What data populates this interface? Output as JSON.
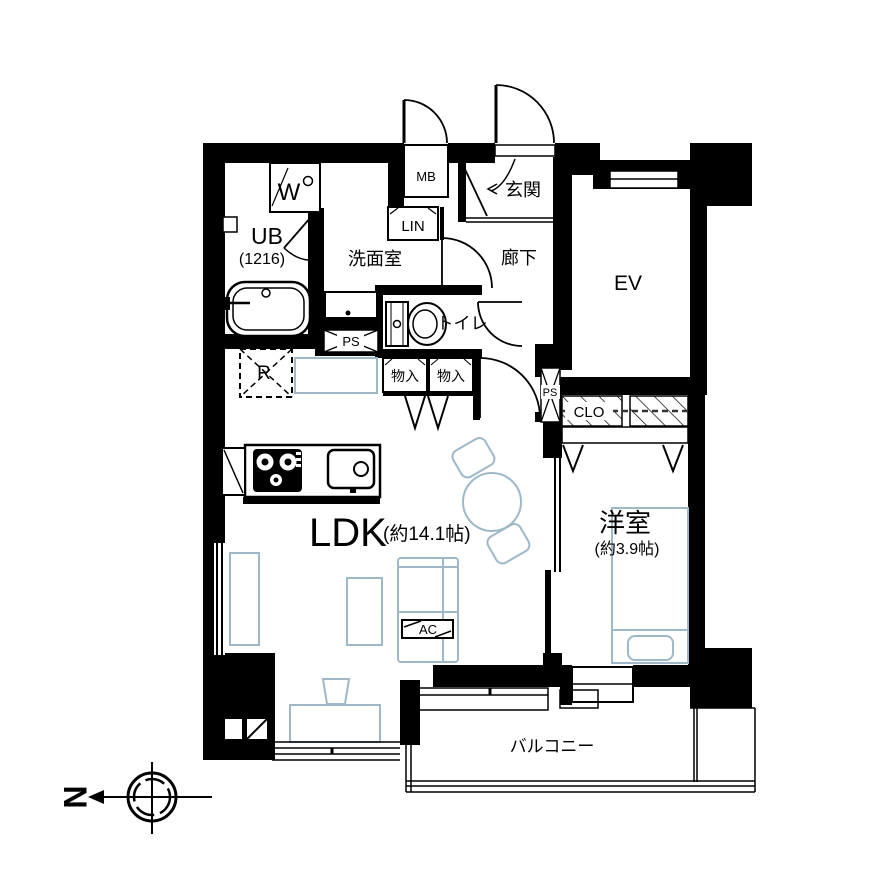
{
  "meta": {
    "type": "apartment-floor-plan"
  },
  "colors": {
    "wall": "#000000",
    "furniture": "#9eb8c8",
    "background": "#ffffff"
  },
  "rooms": {
    "ldk": {
      "name": "LDK",
      "size": "(約14.1帖)"
    },
    "western_room": {
      "name": "洋室",
      "size": "(約3.9帖)"
    },
    "unit_bath": {
      "name": "UB",
      "size": "(1216)"
    },
    "washroom": {
      "name": "洗面室"
    },
    "entrance": {
      "name": "玄関"
    },
    "hallway": {
      "name": "廊下"
    },
    "toilet": {
      "name": "トイレ"
    },
    "elevator": {
      "name": "EV"
    },
    "balcony": {
      "name": "バルコニー"
    },
    "closet": {
      "name": "CLO"
    },
    "linen": {
      "name": "LIN"
    },
    "meter_box": {
      "name": "MB"
    },
    "storage_1": {
      "name": "物入"
    },
    "storage_2": {
      "name": "物入"
    },
    "pipe_space_1": {
      "name": "PS"
    },
    "pipe_space_2": {
      "name": "PS"
    },
    "refrigerator": {
      "name": "R"
    },
    "washer": {
      "name": "W"
    },
    "air_conditioner": {
      "name": "AC"
    }
  },
  "compass": {
    "direction": "N"
  }
}
